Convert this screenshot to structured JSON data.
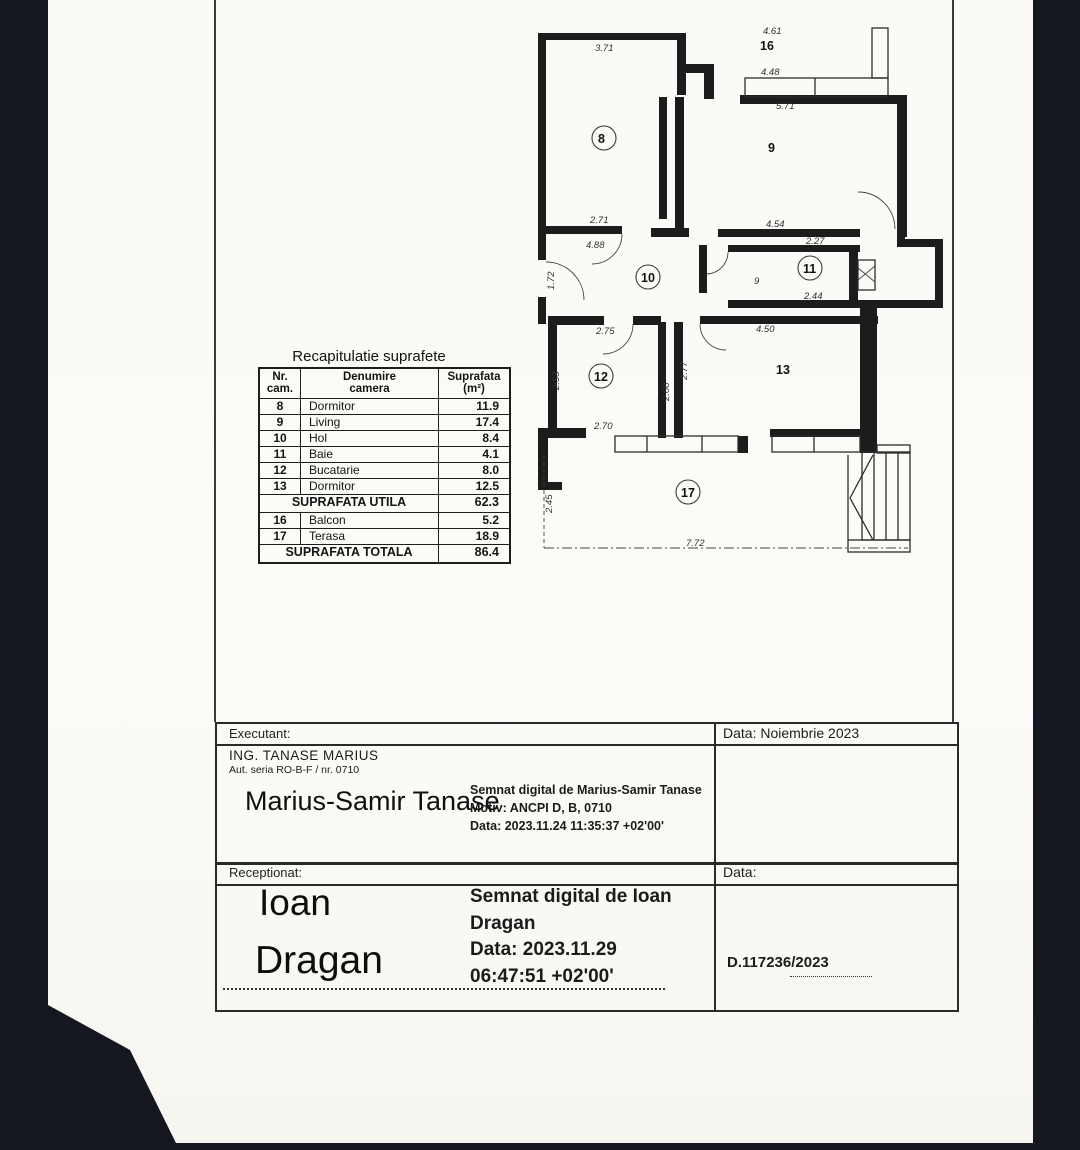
{
  "recap_table": {
    "title": "Recapitulatie suprafete",
    "headers": {
      "col1a": "Nr.",
      "col1b": "cam.",
      "col2a": "Denumire",
      "col2b": "camera",
      "col3a": "Suprafata",
      "col3b": "(m²)"
    },
    "rows": [
      {
        "nr": "8",
        "name": "Dormitor",
        "area": "11.9"
      },
      {
        "nr": "9",
        "name": "Living",
        "area": "17.4"
      },
      {
        "nr": "10",
        "name": "Hol",
        "area": "8.4"
      },
      {
        "nr": "11",
        "name": "Baie",
        "area": "4.1"
      },
      {
        "nr": "12",
        "name": "Bucatarie",
        "area": "8.0"
      },
      {
        "nr": "13",
        "name": "Dormitor",
        "area": "12.5"
      }
    ],
    "utila_label": "SUPRAFATA UTILA",
    "utila_value": "62.3",
    "extra_rows": [
      {
        "nr": "16",
        "name": "Balcon",
        "area": "5.2"
      },
      {
        "nr": "17",
        "name": "Terasa",
        "area": "18.9"
      }
    ],
    "totala_label": "SUPRAFATA TOTALA",
    "totala_value": "86.4"
  },
  "floor_plan": {
    "rooms": [
      {
        "label": "8"
      },
      {
        "label": "9"
      },
      {
        "label": "10"
      },
      {
        "label": "11"
      },
      {
        "label": "12"
      },
      {
        "label": "13"
      },
      {
        "label": "16"
      },
      {
        "label": "17"
      }
    ],
    "dimensions": [
      "3.71",
      "2.71",
      "4.88",
      "1.72",
      "4.61",
      "4.48",
      "5.71",
      "4.54",
      "2.27",
      "2.44",
      "2.75",
      "2.53",
      "2.08",
      "2.77",
      "4.50",
      "2.70",
      "2.45",
      "7.72",
      "9"
    ]
  },
  "signature_table": {
    "executant_label": "Executant:",
    "data1": "Data: Noiembrie 2023",
    "engineer_line1": "ING. TANASE  MARIUS",
    "engineer_line2": "Aut. seria RO-B-F / nr. 0710",
    "signature1": "Marius-Samir Tanase",
    "digital1_line1": "Semnat digital de Marius-Samir Tanase",
    "digital1_line2": "Motiv: ANCPI D, B, 0710",
    "digital1_line3": "Data: 2023.11.24 11:35:37 +02'00'",
    "receptionat_label": "Receptionat:",
    "data2_label": "Data:",
    "signature2_line1": "Ioan",
    "signature2_line2": "Dragan",
    "digital2_line1": "Semnat digital de Ioan",
    "digital2_line2": "Dragan",
    "digital2_line3": "Data: 2023.11.29",
    "digital2_line4": "06:47:51 +02'00'",
    "registration": "D.117236/2023"
  }
}
